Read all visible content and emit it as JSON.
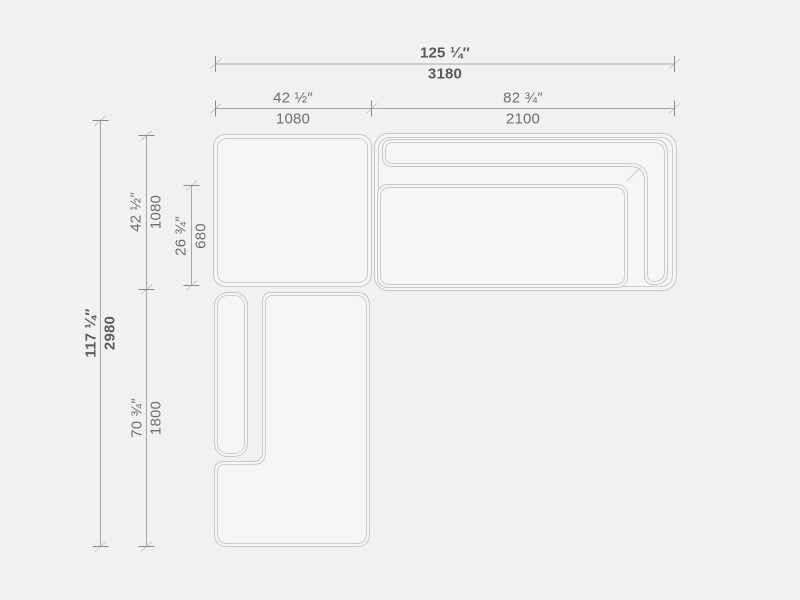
{
  "drawing": {
    "type": "sectional-sofa-top-view-technical-drawing",
    "units": [
      "inches",
      "mm"
    ]
  },
  "colors": {
    "background": "#f1f1f1",
    "shape_fill": "#f6f6f6",
    "shape_line": "#c8c8c8",
    "dimension_line": "#a6a6a6",
    "tick": "#8a8a8a",
    "text": "#6e6e6e",
    "text_strong": "#5a5a5a"
  },
  "dims": {
    "overall_width": {
      "inches": "125 ¼″",
      "mm": "3180"
    },
    "left_module_width": {
      "inches": "42 ½″",
      "mm": "1080"
    },
    "right_module_width": {
      "inches": "82 ¾″",
      "mm": "2100"
    },
    "overall_depth": {
      "inches": "117 ¼″",
      "mm": "2980"
    },
    "top_module_depth": {
      "inches": "42 ½″",
      "mm": "1080"
    },
    "seat_depth": {
      "inches": "26 ¾″",
      "mm": "680"
    },
    "chaise_length": {
      "inches": "70 ¾″",
      "mm": "1800"
    }
  }
}
